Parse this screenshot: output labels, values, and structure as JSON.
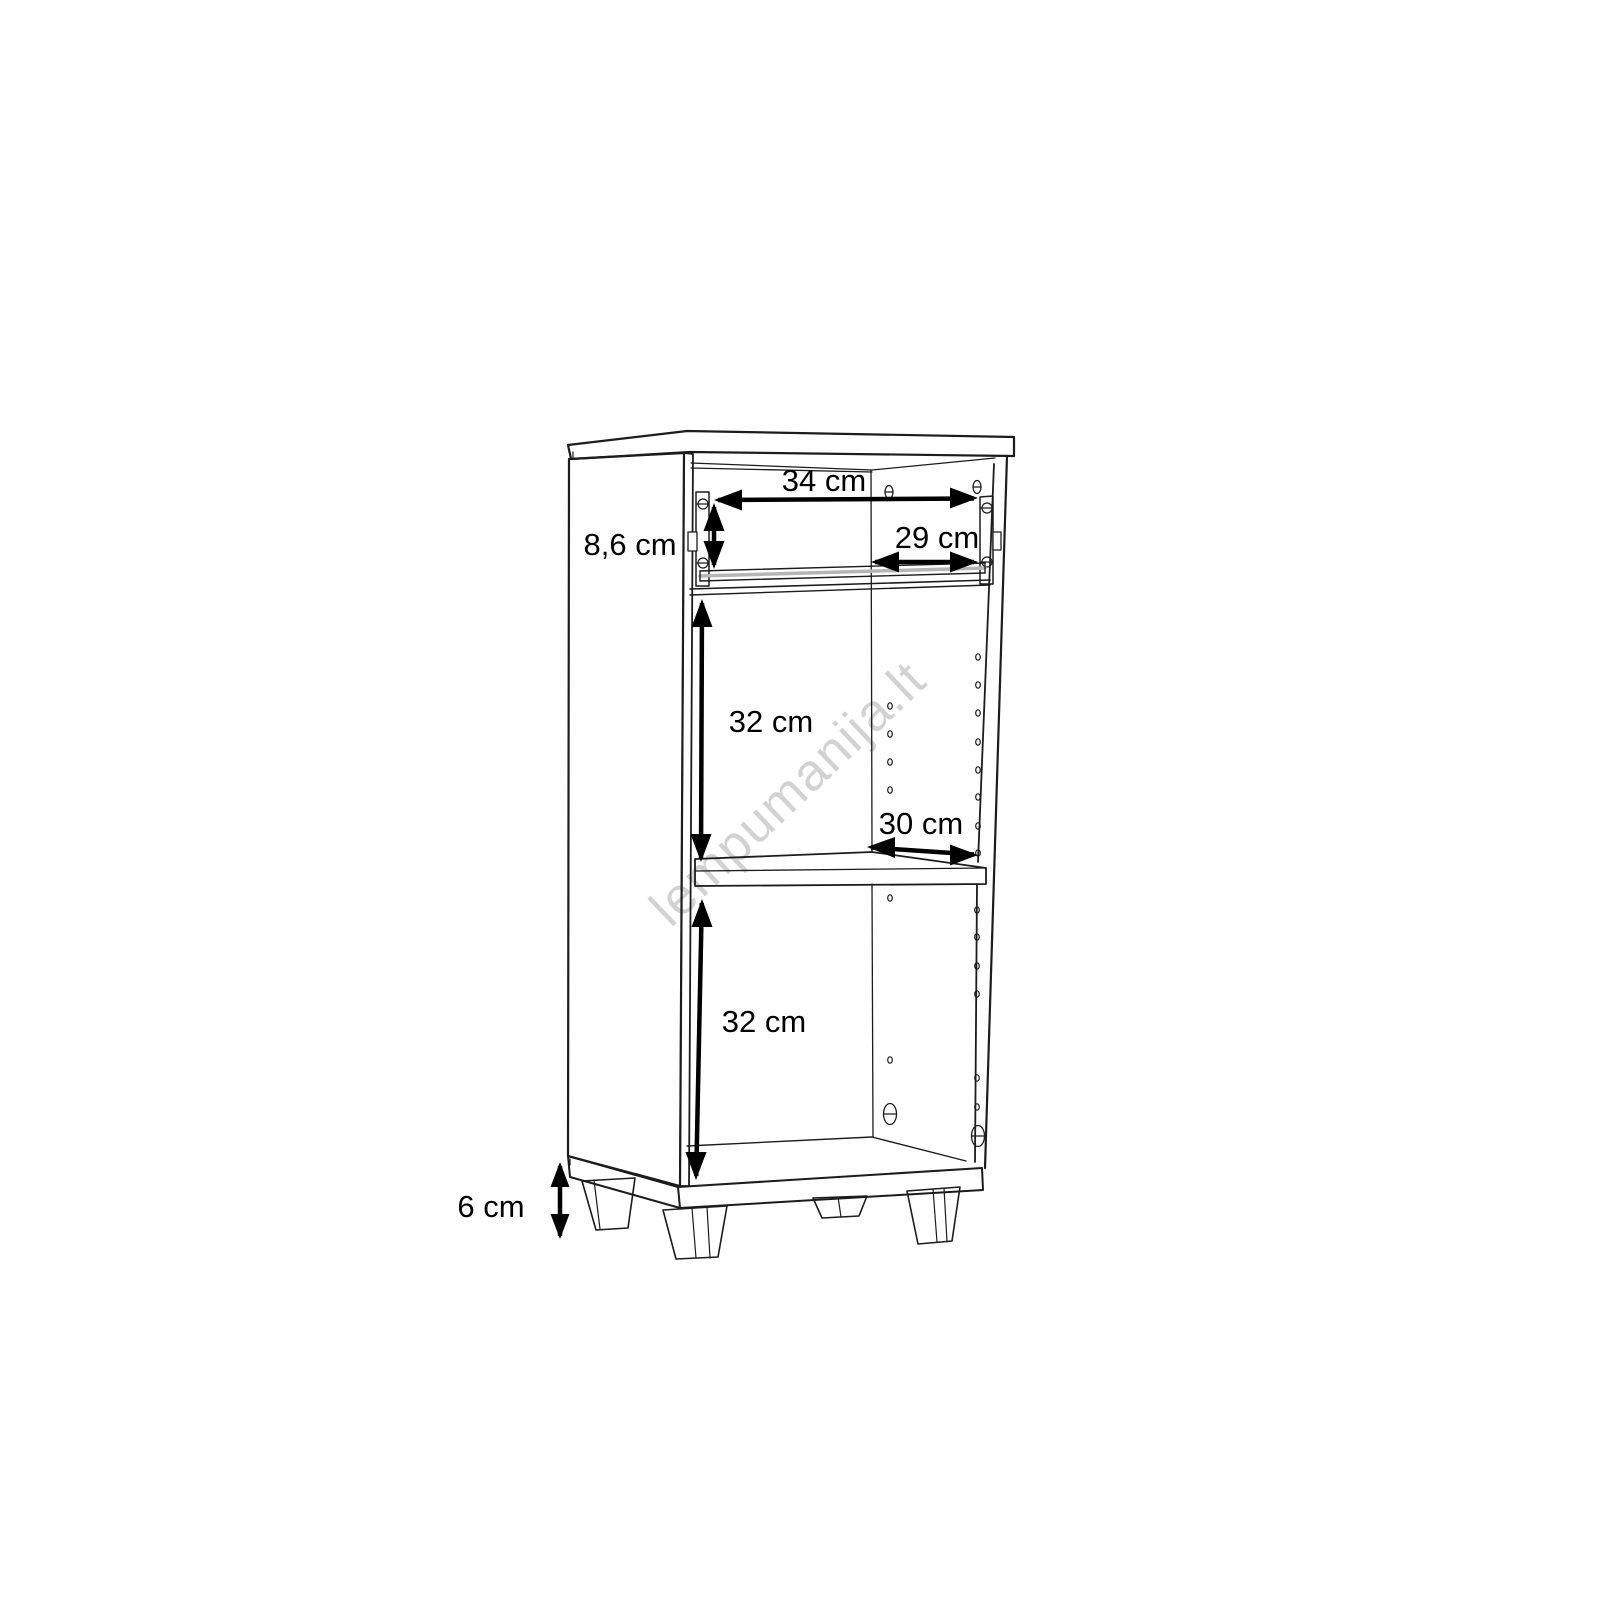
{
  "page": {
    "background": "#ffffff",
    "width": 1600,
    "height": 1600
  },
  "diagram": {
    "type": "furniture-dimension-drawing",
    "subject": "open-shelf-cabinet-with-drawer-rails-and-legs",
    "line_color": "#1c1c1c",
    "slide_gray": "#b5b5b5",
    "watermark": {
      "text": "lempumanija.lt",
      "color": "#d2d2d2",
      "rotation_deg": -43.5
    },
    "dimensions": [
      {
        "id": "inner-width-top",
        "label": "34 cm",
        "orientation": "horizontal"
      },
      {
        "id": "drawer-inner-width",
        "label": "29 cm",
        "orientation": "horizontal"
      },
      {
        "id": "top-section-height",
        "label": "8,6 cm",
        "orientation": "vertical"
      },
      {
        "id": "upper-compartment-height",
        "label": "32 cm",
        "orientation": "vertical"
      },
      {
        "id": "shelf-depth",
        "label": "30 cm",
        "orientation": "horizontal"
      },
      {
        "id": "lower-compartment-height",
        "label": "32 cm",
        "orientation": "vertical"
      },
      {
        "id": "leg-height",
        "label": "6 cm",
        "orientation": "vertical"
      }
    ]
  }
}
